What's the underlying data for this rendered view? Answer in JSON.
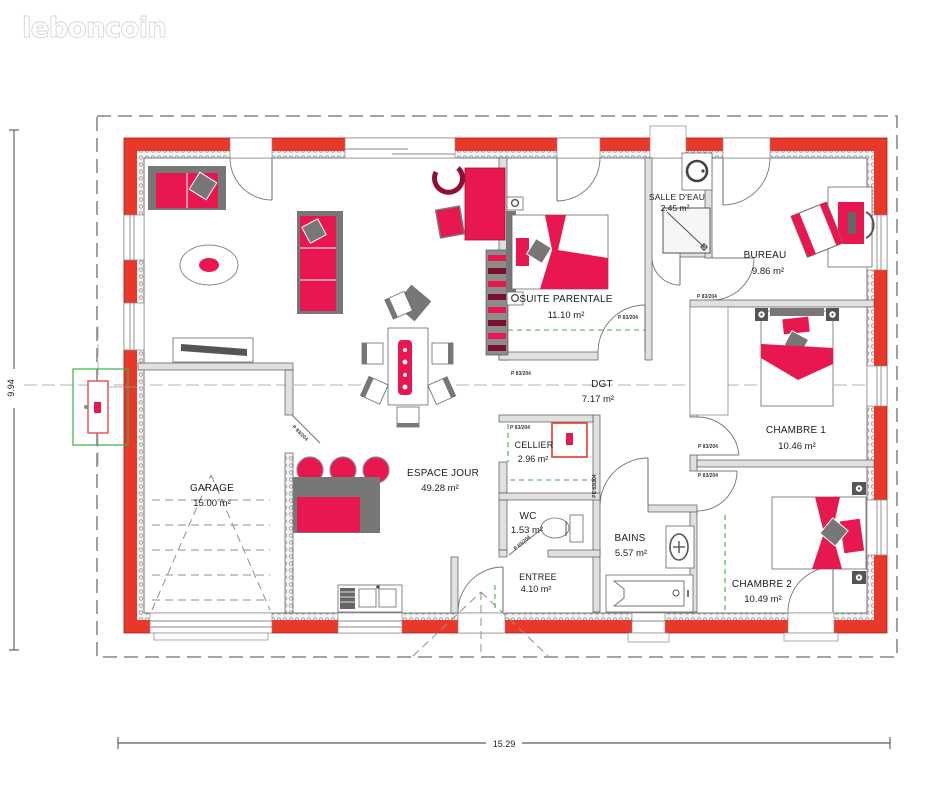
{
  "logo": {
    "text": "leboncoin"
  },
  "dimensions": {
    "width_label": "15.29",
    "height_label": "9.94"
  },
  "rooms": [
    {
      "name": "GARAGE",
      "area": "15.00 m²"
    },
    {
      "name": "ESPACE JOUR",
      "area": "49.28 m²"
    },
    {
      "name": "SUITE PARENTALE",
      "area": "11.10 m²"
    },
    {
      "name": "SALLE D'EAU",
      "area": "2.45 m²"
    },
    {
      "name": "BUREAU",
      "area": "9.86 m²"
    },
    {
      "name": "CHAMBRE 1",
      "area": "10.46 m²"
    },
    {
      "name": "CHAMBRE 2",
      "area": "10.49 m²"
    },
    {
      "name": "BAINS",
      "area": "5.57 m²"
    },
    {
      "name": "WC",
      "area": "1.53 m²"
    },
    {
      "name": "CELLIER",
      "area": "2.96 m²"
    },
    {
      "name": "ENTREE",
      "area": "4.10 m²"
    },
    {
      "name": "DGT",
      "area": "7.17 m²"
    }
  ],
  "door_labels": {
    "standard": "P 83/204",
    "entry": "PE 63/204"
  },
  "colors": {
    "wall": "#e8382c",
    "furniture": "#e8174f",
    "green": "#3cb043"
  }
}
